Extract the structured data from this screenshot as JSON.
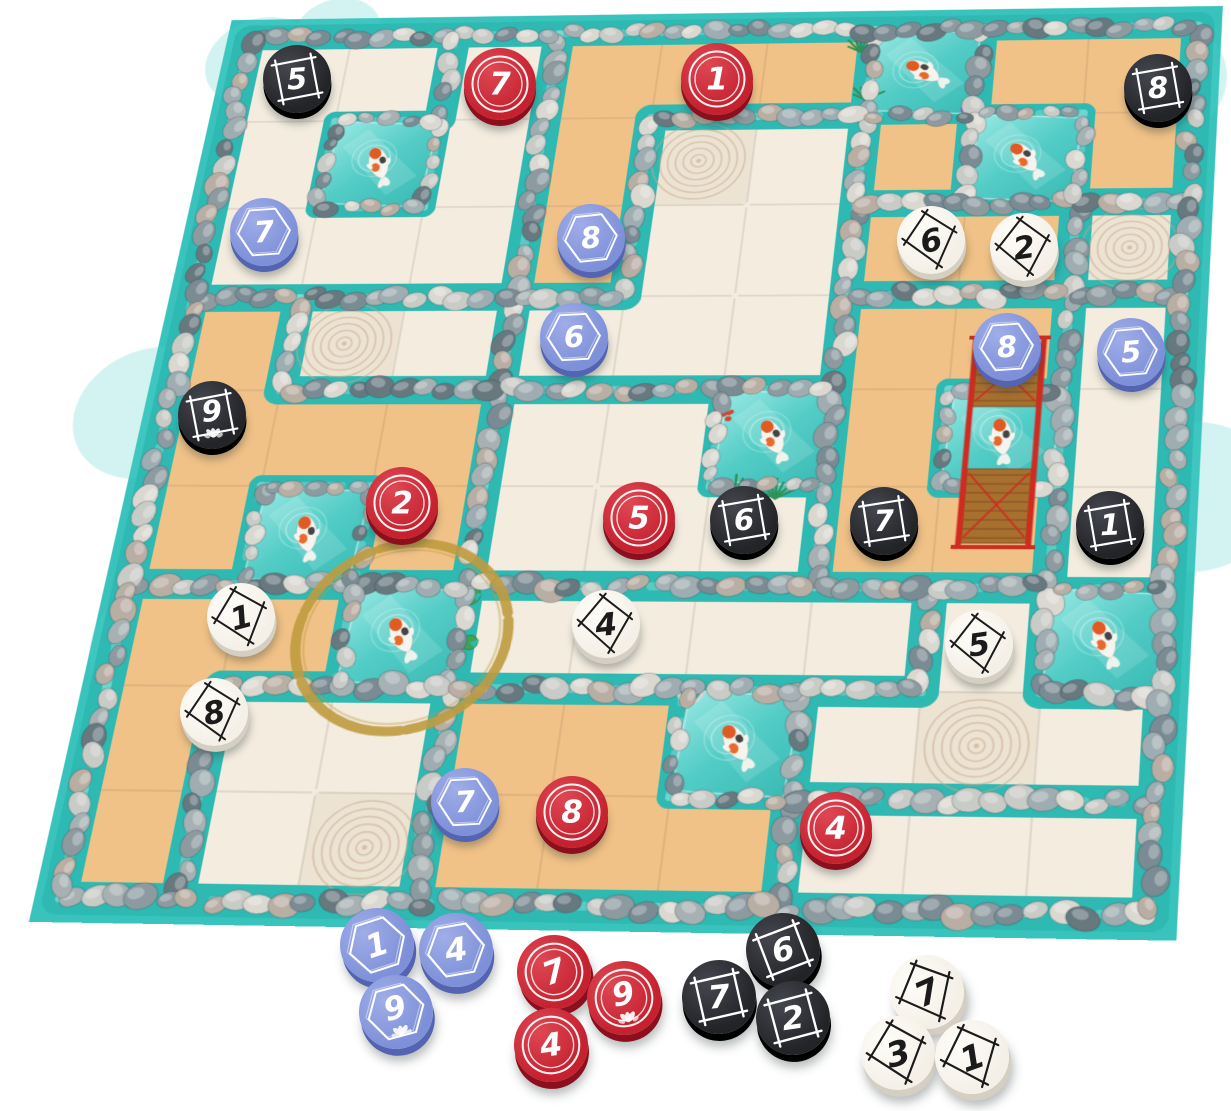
{
  "palette": {
    "water": "#38c3bc",
    "channel": "#2eb9b2",
    "shimmer": "#8be2dc",
    "cream": "#f3ecdf",
    "sand": "#f1c287",
    "zen": "#ece3d3",
    "zen_line": "#c8a88b",
    "grout": "rgba(110,95,75,0.18)",
    "pebbles": [
      "#7b8b94",
      "#9fadb2",
      "#c9cbc7",
      "#67787f",
      "#b9aea4",
      "#dbd8d2",
      "#8d9ba1",
      "#a7b1b3"
    ],
    "gold": "#bf9b3f",
    "board_edge": "#c6c9c8",
    "board_edge_right": "#d6d8d7",
    "grass": "#2f9158",
    "coral": "#cf4a35",
    "flower": "#c05fc9",
    "lily": "#3aa655",
    "bridge": "#a8702f",
    "bridge_dark": "#7a4a1e",
    "bridge_rail": "#d02b20",
    "fish_body": "#f6f4ee",
    "fish_orange": "#e05a21",
    "fish_dark": "#242424",
    "pond_light": "#9ceae5",
    "pond_mid": "#55cdc7",
    "pond_deep": "#3bbcb6"
  },
  "token_styles": {
    "black": {
      "top": "#232428",
      "light": "#45474f",
      "rim": "#000000",
      "fg": "#ffffff",
      "frame": "square"
    },
    "red": {
      "top": "#c5212f",
      "light": "#de4853",
      "rim": "#8c0f1e",
      "fg": "#ffffff",
      "frame": "rings"
    },
    "blue": {
      "top": "#7e90d8",
      "light": "#9fade8",
      "rim": "#5464b2",
      "fg": "#ffffff",
      "frame": "hex"
    },
    "white": {
      "top": "#f4f0e8",
      "light": "#fffdf8",
      "rim": "#d5cfc3",
      "fg": "#1b1b1b",
      "frame": "kite"
    }
  },
  "board": {
    "region_rows": [
      "AAABBBCDD",
      "AAABEECDD",
      "AAABEEFFG",
      "HIIEEELLK",
      "HHHJJJLLK",
      "HHHJJJLLK",
      "MMMNNNNOK",
      "MQQRRROOO",
      "MQQRRRSSS"
    ],
    "color_rows": [
      "cccsssPss",
      "cPcszcsPs",
      "cccsccssz",
      "szccccssc",
      "sssccPsPc",
      "sPscccssc",
      "ssPcccccP",
      "sccssPczc",
      "sczsssccc"
    ],
    "extra_walls": [
      [
        "v",
        2,
        0
      ]
    ]
  },
  "ponds": [
    {
      "col": 1,
      "row": 1,
      "fish": 250
    },
    {
      "col": 6,
      "row": 0,
      "fish": 215,
      "lily": [
        [
          103,
          46
        ]
      ],
      "grass": [
        [
          -2,
          82
        ],
        [
          -12,
          26
        ]
      ]
    },
    {
      "col": 7,
      "row": 1,
      "fish": 235,
      "flowers": [
        [
          0,
          -4
        ]
      ]
    },
    {
      "col": 5,
      "row": 4,
      "fish": 245,
      "coral": [
        [
          5,
          30
        ]
      ],
      "grass": [
        [
          22,
          108
        ],
        [
          58,
          112
        ]
      ]
    },
    {
      "col": 7,
      "row": 4,
      "fish": 262,
      "bridge": true
    },
    {
      "col": 1,
      "row": 5,
      "fish": 255
    },
    {
      "col": 2,
      "row": 6,
      "fish": 242,
      "gold_ring": true,
      "lily": [
        [
          104,
          10
        ],
        [
          110,
          56
        ]
      ]
    },
    {
      "col": 8,
      "row": 6,
      "fish": 250
    },
    {
      "col": 5,
      "row": 7,
      "fish": 240,
      "bucket": [
        [
          6,
          2
        ]
      ]
    }
  ],
  "board_tokens": [
    {
      "cell": [
        0,
        0
      ],
      "x": 297,
      "y": 79,
      "color": "black",
      "value": 5,
      "rot": -4
    },
    {
      "cell": [
        2,
        0
      ],
      "x": 500,
      "y": 84,
      "color": "red",
      "value": 7,
      "rot": 0
    },
    {
      "cell": [
        4,
        0
      ],
      "x": 717,
      "y": 79,
      "color": "red",
      "value": 1,
      "rot": 0
    },
    {
      "cell": [
        8,
        0
      ],
      "x": 1158,
      "y": 88,
      "color": "black",
      "value": 8,
      "rot": -3
    },
    {
      "cell": [
        0,
        2
      ],
      "x": 264,
      "y": 232,
      "color": "blue",
      "value": 7,
      "rot": -4
    },
    {
      "cell": [
        3,
        2
      ],
      "x": 591,
      "y": 238,
      "color": "blue",
      "value": 8,
      "rot": -6
    },
    {
      "cell": [
        6,
        2
      ],
      "x": 931,
      "y": 240,
      "color": "white",
      "value": 6,
      "rot": -12
    },
    {
      "cell": [
        7,
        2
      ],
      "x": 1024,
      "y": 247,
      "color": "white",
      "value": 2,
      "rot": -8
    },
    {
      "cell": [
        3,
        3
      ],
      "x": 574,
      "y": 337,
      "color": "blue",
      "value": 6,
      "rot": -3
    },
    {
      "cell": [
        7,
        3
      ],
      "x": 1007,
      "y": 347,
      "color": "blue",
      "value": 8,
      "rot": -4
    },
    {
      "cell": [
        8,
        3
      ],
      "x": 1131,
      "y": 352,
      "color": "blue",
      "value": 5,
      "rot": -5
    },
    {
      "cell": [
        0,
        4
      ],
      "x": 212,
      "y": 415,
      "color": "black",
      "value": 9,
      "rot": -4,
      "lotus": true
    },
    {
      "cell": [
        2,
        5
      ],
      "x": 402,
      "y": 503,
      "color": "red",
      "value": 2,
      "rot": 0
    },
    {
      "cell": [
        4,
        5
      ],
      "x": 639,
      "y": 518,
      "color": "red",
      "value": 5,
      "rot": 0
    },
    {
      "cell": [
        5,
        5
      ],
      "x": 744,
      "y": 520,
      "color": "black",
      "value": 6,
      "rot": -3
    },
    {
      "cell": [
        6,
        5
      ],
      "x": 884,
      "y": 521,
      "color": "black",
      "value": 7,
      "rot": -2
    },
    {
      "cell": [
        8,
        5
      ],
      "x": 1110,
      "y": 525,
      "color": "black",
      "value": 1,
      "rot": -3
    },
    {
      "cell": [
        0,
        6
      ],
      "x": 241,
      "y": 617,
      "color": "white",
      "value": 1,
      "rot": -15
    },
    {
      "cell": [
        4,
        6
      ],
      "x": 606,
      "y": 624,
      "color": "white",
      "value": 4,
      "rot": -6
    },
    {
      "cell": [
        7,
        6
      ],
      "x": 979,
      "y": 644,
      "color": "white",
      "value": 5,
      "rot": -8
    },
    {
      "cell": [
        0,
        7
      ],
      "x": 214,
      "y": 712,
      "color": "white",
      "value": 8,
      "rot": -12
    },
    {
      "cell": [
        3,
        8
      ],
      "x": 465,
      "y": 802,
      "color": "blue",
      "value": 7,
      "rot": -3
    },
    {
      "cell": [
        4,
        8
      ],
      "x": 572,
      "y": 812,
      "color": "red",
      "value": 8,
      "rot": 0
    },
    {
      "cell": [
        6,
        8
      ],
      "x": 836,
      "y": 828,
      "color": "red",
      "value": 4,
      "rot": 0
    }
  ],
  "loose_tokens": [
    {
      "x": 377,
      "y": 945,
      "color": "blue",
      "value": 1,
      "rot": -18
    },
    {
      "x": 456,
      "y": 950,
      "color": "blue",
      "value": 4,
      "rot": -10
    },
    {
      "x": 396,
      "y": 1012,
      "color": "blue",
      "value": 9,
      "rot": -15,
      "lotus": true
    },
    {
      "x": 554,
      "y": 972,
      "color": "red",
      "value": 7,
      "rot": -20
    },
    {
      "x": 624,
      "y": 998,
      "color": "red",
      "value": 9,
      "rot": -12,
      "lotus": true
    },
    {
      "x": 551,
      "y": 1045,
      "color": "red",
      "value": 4,
      "rot": -8
    },
    {
      "x": 783,
      "y": 950,
      "color": "black",
      "value": 6,
      "rot": -14
    },
    {
      "x": 719,
      "y": 997,
      "color": "black",
      "value": 7,
      "rot": -6
    },
    {
      "x": 793,
      "y": 1018,
      "color": "black",
      "value": 2,
      "rot": -8
    },
    {
      "x": 927,
      "y": 992,
      "color": "white",
      "value": 7,
      "rot": -24
    },
    {
      "x": 898,
      "y": 1053,
      "color": "white",
      "value": 3,
      "rot": -15
    },
    {
      "x": 972,
      "y": 1057,
      "color": "white",
      "value": 1,
      "rot": -20
    }
  ]
}
